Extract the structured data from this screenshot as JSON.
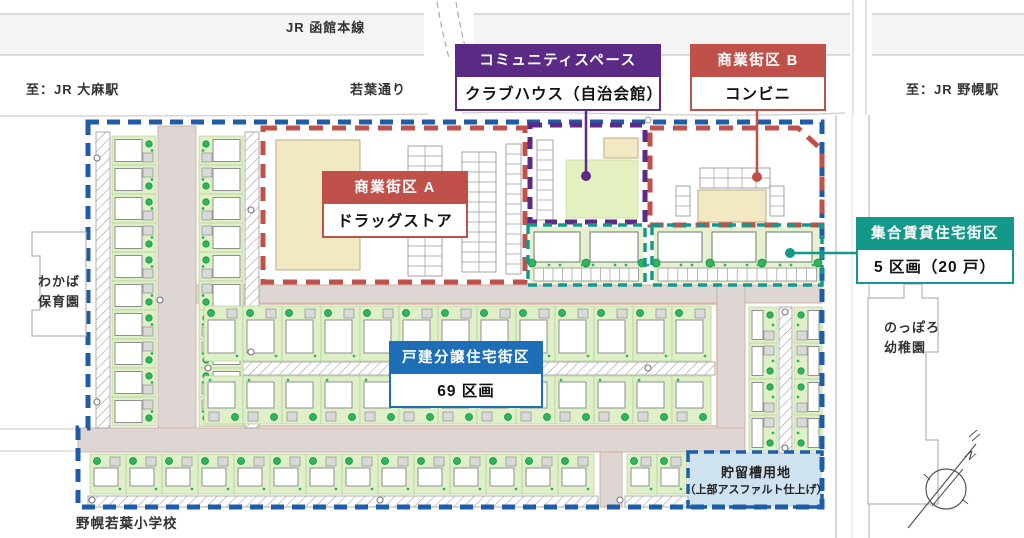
{
  "top_labels": {
    "railway": "JR 函館本線",
    "to_oasa": "至：JR 大麻駅",
    "wakaba_street": "若葉通り",
    "to_nopporo": "至：JR 野幌駅"
  },
  "callouts": {
    "community_space": {
      "title": "コミュニティスペース",
      "body": "クラブハウス（自治会館）"
    },
    "commercial_b": {
      "title": "商業街区 B",
      "body": "コンビニ"
    },
    "commercial_a": {
      "title": "商業街区 A",
      "body": "ドラッグストア"
    },
    "rental_housing": {
      "title": "集合賃貸住宅街区",
      "body": "5 区画（20 戸）"
    },
    "detached_housing": {
      "title": "戸建分譲住宅街区",
      "body": "69 区画"
    }
  },
  "place_labels": {
    "nursery_l1": "わかば",
    "nursery_l2": "保育園",
    "kindergarten_l1": "のっぽろ",
    "kindergarten_l2": "幼稚園",
    "storage_l1": "貯留槽用地",
    "storage_l2": "（上部アスファルト仕上げ）",
    "school": "野幌若葉小学校",
    "compass_n": "N"
  },
  "colors": {
    "site_boundary": "#1e5ca8",
    "commercial": "#c0504a",
    "community_space": "#5a2a85",
    "rental_housing": "#14988a",
    "detached_housing": "#1d6db7",
    "road": "#ded6d3",
    "residential_lot": "#dff0c8",
    "tree": "#2fb45f",
    "commercial_building": "#f2e8c2",
    "storage_site": "#cfe2f0"
  }
}
